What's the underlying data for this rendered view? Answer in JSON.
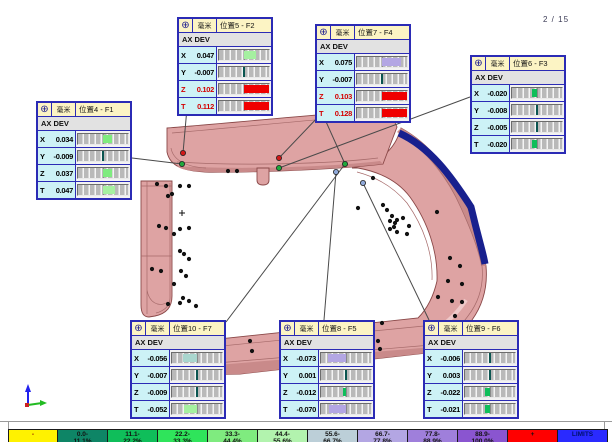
{
  "page": {
    "indicator": "2 / 15"
  },
  "icons": {
    "target": "⊕"
  },
  "callouts": [
    {
      "id": "F1",
      "unit": "毫米",
      "title": "位置4 - F1",
      "section": "AX DEV",
      "pos": {
        "x": 36,
        "y": 101
      },
      "rows": [
        {
          "axis": "X",
          "value": "0.034",
          "red": false,
          "bar": {
            "pct": 34,
            "side": "pos",
            "color": "#7FEB7F"
          }
        },
        {
          "axis": "Y",
          "value": "-0.009",
          "red": false,
          "bar": null
        },
        {
          "axis": "Z",
          "value": "0.037",
          "red": false,
          "bar": {
            "pct": 37,
            "side": "pos",
            "color": "#7FEB7F"
          }
        },
        {
          "axis": "T",
          "value": "0.047",
          "red": false,
          "bar": {
            "pct": 47,
            "side": "pos",
            "color": "#A5F0A0"
          }
        }
      ]
    },
    {
      "id": "F2",
      "unit": "毫米",
      "title": "位置5 - F2",
      "section": "AX DEV",
      "pos": {
        "x": 177,
        "y": 17
      },
      "rows": [
        {
          "axis": "X",
          "value": "0.047",
          "red": false,
          "bar": {
            "pct": 47,
            "side": "pos",
            "color": "#A5F0A0"
          }
        },
        {
          "axis": "Y",
          "value": "-0.007",
          "red": false,
          "bar": null
        },
        {
          "axis": "Z",
          "value": "0.102",
          "red": true,
          "bar": {
            "pct": 100,
            "side": "pos",
            "color": "#F00000"
          }
        },
        {
          "axis": "T",
          "value": "0.112",
          "red": true,
          "bar": {
            "pct": 100,
            "side": "pos",
            "color": "#F00000"
          }
        }
      ]
    },
    {
      "id": "F4",
      "unit": "毫米",
      "title": "位置7 - F4",
      "section": "AX DEV",
      "pos": {
        "x": 315,
        "y": 24
      },
      "rows": [
        {
          "axis": "X",
          "value": "0.075",
          "red": false,
          "bar": {
            "pct": 75,
            "side": "pos",
            "color": "#B3A6E3"
          }
        },
        {
          "axis": "Y",
          "value": "-0.007",
          "red": false,
          "bar": null
        },
        {
          "axis": "Z",
          "value": "0.103",
          "red": true,
          "bar": {
            "pct": 100,
            "side": "pos",
            "color": "#F00000"
          }
        },
        {
          "axis": "T",
          "value": "0.128",
          "red": true,
          "bar": {
            "pct": 100,
            "side": "pos",
            "color": "#F00000"
          }
        }
      ]
    },
    {
      "id": "F3",
      "unit": "毫米",
      "title": "位置6 - F3",
      "section": "AX DEV",
      "pos": {
        "x": 470,
        "y": 55
      },
      "rows": [
        {
          "axis": "X",
          "value": "-0.020",
          "red": false,
          "bar": {
            "pct": 20,
            "side": "neg",
            "color": "#0FBE5A"
          }
        },
        {
          "axis": "Y",
          "value": "-0.008",
          "red": false,
          "bar": null
        },
        {
          "axis": "Z",
          "value": "-0.005",
          "red": false,
          "bar": null
        },
        {
          "axis": "T",
          "value": "-0.020",
          "red": false,
          "bar": {
            "pct": 20,
            "side": "neg",
            "color": "#0FBE5A"
          }
        }
      ]
    },
    {
      "id": "F7",
      "unit": "毫米",
      "title": "位置10 - F7",
      "section": "AX DEV",
      "pos": {
        "x": 130,
        "y": 320
      },
      "rows": [
        {
          "axis": "X",
          "value": "-0.056",
          "red": false,
          "bar": {
            "pct": 56,
            "side": "neg",
            "color": "#A9D6CE"
          }
        },
        {
          "axis": "Y",
          "value": "-0.007",
          "red": false,
          "bar": null
        },
        {
          "axis": "Z",
          "value": "-0.009",
          "red": false,
          "bar": null
        },
        {
          "axis": "T",
          "value": "-0.052",
          "red": false,
          "bar": {
            "pct": 52,
            "side": "neg",
            "color": "#A5F0A0"
          }
        }
      ]
    },
    {
      "id": "F5",
      "unit": "毫米",
      "title": "位置8 - F5",
      "section": "AX DEV",
      "pos": {
        "x": 279,
        "y": 320
      },
      "rows": [
        {
          "axis": "X",
          "value": "-0.073",
          "red": false,
          "bar": {
            "pct": 73,
            "side": "neg",
            "color": "#B3A6E3"
          }
        },
        {
          "axis": "Y",
          "value": "0.001",
          "red": false,
          "bar": null
        },
        {
          "axis": "Z",
          "value": "-0.012",
          "red": false,
          "bar": {
            "pct": 12,
            "side": "neg",
            "color": "#0FBE5A"
          }
        },
        {
          "axis": "T",
          "value": "-0.070",
          "red": false,
          "bar": {
            "pct": 70,
            "side": "neg",
            "color": "#B3A6E3"
          }
        }
      ]
    },
    {
      "id": "F6",
      "unit": "毫米",
      "title": "位置9 - F6",
      "section": "AX DEV",
      "pos": {
        "x": 423,
        "y": 320
      },
      "rows": [
        {
          "axis": "X",
          "value": "-0.006",
          "red": false,
          "bar": null
        },
        {
          "axis": "Y",
          "value": "0.003",
          "red": false,
          "bar": null
        },
        {
          "axis": "Z",
          "value": "-0.022",
          "red": false,
          "bar": {
            "pct": 22,
            "side": "neg",
            "color": "#0FBE5A"
          }
        },
        {
          "axis": "T",
          "value": "-0.021",
          "red": false,
          "bar": {
            "pct": 21,
            "side": "neg",
            "color": "#0FBE5A"
          }
        }
      ]
    }
  ],
  "leaders": [
    {
      "x1": 132,
      "y1": 158,
      "x2": 182,
      "y2": 164
    },
    {
      "x1": 187,
      "y1": 108,
      "x2": 183,
      "y2": 153
    },
    {
      "x1": 320,
      "y1": 115,
      "x2": 279,
      "y2": 158
    },
    {
      "x1": 323,
      "y1": 115,
      "x2": 345,
      "y2": 164
    },
    {
      "x1": 470,
      "y1": 97,
      "x2": 279,
      "y2": 168
    },
    {
      "x1": 226,
      "y1": 322,
      "x2": 345,
      "y2": 164
    },
    {
      "x1": 324,
      "y1": 320,
      "x2": 336,
      "y2": 172
    },
    {
      "x1": 429,
      "y1": 320,
      "x2": 363,
      "y2": 183
    }
  ],
  "anchors": [
    {
      "x": 182,
      "y": 164,
      "color": "#1fa83c"
    },
    {
      "x": 183,
      "y": 153,
      "color": "#d01818"
    },
    {
      "x": 279,
      "y": 158,
      "color": "#d01818"
    },
    {
      "x": 279,
      "y": 168,
      "color": "#1fa83c"
    },
    {
      "x": 345,
      "y": 164,
      "color": "#1fa83c"
    },
    {
      "x": 336,
      "y": 172,
      "color": "#8fa8d8"
    },
    {
      "x": 363,
      "y": 183,
      "color": "#8fa8d8"
    }
  ],
  "points": [
    [
      157,
      184
    ],
    [
      166,
      186
    ],
    [
      180,
      186
    ],
    [
      189,
      186
    ],
    [
      172,
      194
    ],
    [
      168,
      196
    ],
    [
      159,
      226
    ],
    [
      166,
      228
    ],
    [
      180,
      229
    ],
    [
      189,
      228
    ],
    [
      174,
      234
    ],
    [
      180,
      251
    ],
    [
      184,
      254
    ],
    [
      189,
      259
    ],
    [
      181,
      271
    ],
    [
      186,
      276
    ],
    [
      174,
      284
    ],
    [
      183,
      298
    ],
    [
      180,
      303
    ],
    [
      189,
      301
    ],
    [
      196,
      306
    ],
    [
      168,
      304
    ],
    [
      152,
      269
    ],
    [
      161,
      271
    ],
    [
      228,
      171
    ],
    [
      237,
      171
    ],
    [
      358,
      208
    ],
    [
      373,
      178
    ],
    [
      383,
      205
    ],
    [
      387,
      210
    ],
    [
      392,
      216
    ],
    [
      390,
      221
    ],
    [
      395,
      223
    ],
    [
      397,
      220
    ],
    [
      394,
      227
    ],
    [
      390,
      229
    ],
    [
      397,
      232
    ],
    [
      403,
      218
    ],
    [
      409,
      226
    ],
    [
      407,
      234
    ],
    [
      437,
      212
    ],
    [
      450,
      258
    ],
    [
      460,
      266
    ],
    [
      448,
      281
    ],
    [
      462,
      284
    ],
    [
      452,
      301
    ],
    [
      462,
      302
    ],
    [
      438,
      297
    ],
    [
      455,
      316
    ],
    [
      448,
      330
    ],
    [
      382,
      323
    ],
    [
      378,
      341
    ],
    [
      380,
      349
    ],
    [
      250,
      341
    ],
    [
      252,
      351
    ]
  ],
  "plus_mark": {
    "x": 182,
    "y": 213
  },
  "legend": {
    "cells": [
      {
        "line1": "-",
        "line2": "",
        "bg": "#FFF200"
      },
      {
        "line1": "0.0-",
        "line2": "11.1%",
        "bg": "#0E8566"
      },
      {
        "line1": "11.1-",
        "line2": "22.2%",
        "bg": "#0FBE5A"
      },
      {
        "line1": "22.2-",
        "line2": "33.3%",
        "bg": "#2FE45B"
      },
      {
        "line1": "33.3-",
        "line2": "44.4%",
        "bg": "#7FEB7F"
      },
      {
        "line1": "44.4-",
        "line2": "55.6%",
        "bg": "#B2F3AE"
      },
      {
        "line1": "55.6-",
        "line2": "66.7%",
        "bg": "#BCCFD8"
      },
      {
        "line1": "66.7-",
        "line2": "77.8%",
        "bg": "#B3A6E3"
      },
      {
        "line1": "77.8-",
        "line2": "88.9%",
        "bg": "#9F7FDB"
      },
      {
        "line1": "88.9-",
        "line2": "100.0%",
        "bg": "#8A55D0"
      },
      {
        "line1": "+",
        "line2": "",
        "bg": "#FF0000"
      },
      {
        "line1": "LIMITS",
        "line2": "",
        "bg": "#2A2AFF"
      }
    ]
  },
  "colors": {
    "surface": "#DEA3A3",
    "surface_dark": "#C98A8A",
    "outline": "#8A4848",
    "feature_line": "#A66A6A",
    "edge_blue": "#18208E",
    "leader": "#4a4a4a",
    "point": "#111111",
    "triad_up": "#2222ee",
    "triad_right": "#22bb22",
    "triad_origin": "#cc2222"
  }
}
